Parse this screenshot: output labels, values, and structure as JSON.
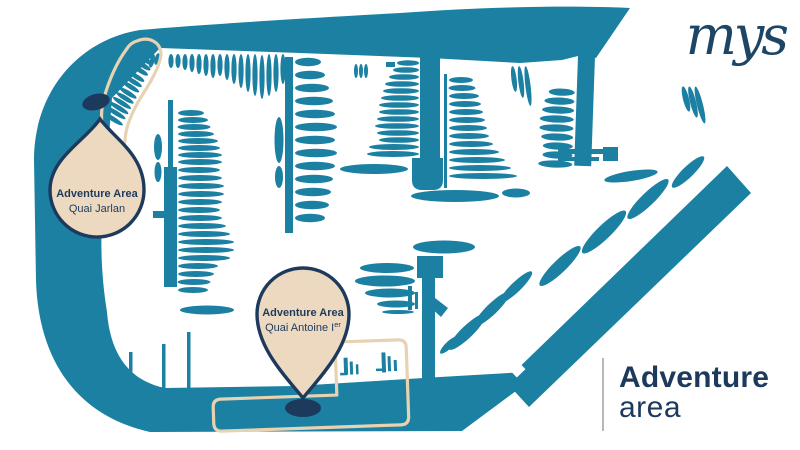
{
  "brand": {
    "logo_text": "mys"
  },
  "map": {
    "pin_jarlan": {
      "title": "Adventure Area",
      "subtitle": "Quai Jarlan"
    },
    "pin_antoine": {
      "title": "Adventure Area",
      "subtitle_main": "Quai Antoine I",
      "subtitle_sup": "er"
    }
  },
  "caption": {
    "line1": "Adventure",
    "line2": "area"
  },
  "colors": {
    "teal": "#1b80a2",
    "navy": "#1d3a5c",
    "logo-navy": "#1d4565",
    "beige": "#ecd9c0",
    "beige-line": "#e7d2b2",
    "line-gray": "#b6b9bc",
    "bg": "#ffffff"
  }
}
